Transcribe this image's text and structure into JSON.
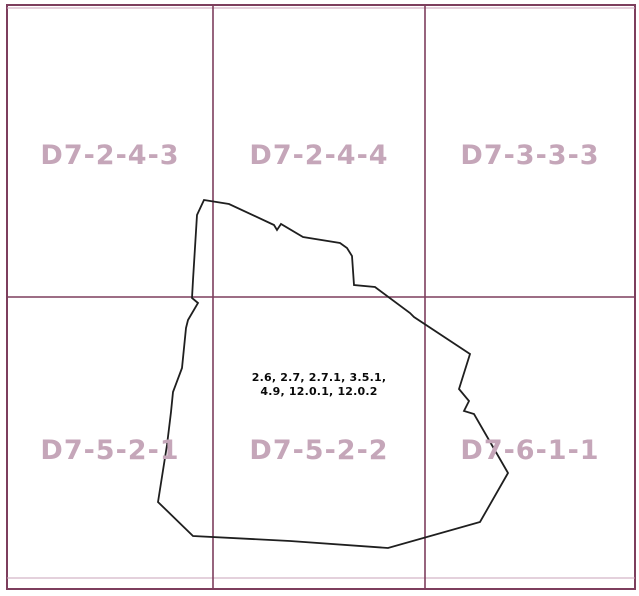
{
  "map": {
    "grid_cells": [
      {
        "label": "D7-2-4-3",
        "row": 1,
        "col": 1
      },
      {
        "label": "D7-2-4-4",
        "row": 1,
        "col": 2
      },
      {
        "label": "D7-3-3-3",
        "row": 1,
        "col": 3
      },
      {
        "label": "D7-5-2-1",
        "row": 2,
        "col": 1
      },
      {
        "label": "D7-5-2-2",
        "row": 2,
        "col": 2
      },
      {
        "label": "D7-6-1-1",
        "row": 2,
        "col": 3
      }
    ],
    "annotation": {
      "line1": "2.6, 2.7, 2.7.1, 3.5.1,",
      "line2": "4.9, 12.0.1, 12.0.2"
    },
    "boundary_polygon": {
      "points": "204,200 229,204 274,225 277,230 281,224 303,237 340,243 347,248 352,256 354,285 375,287 410,313 414,317 470,354 459,389 469,401 464,411 474,414 508,473 480,522 388,548 290,541 193,536 158,502 167,445 171,412 173,392 182,368 186,328 188,320 198,303 192,298 193,280 197,215",
      "stroke_color": "#1f1f1f"
    },
    "colors": {
      "grid_line": "#7d3e5d",
      "grid_line_faint": "#c9a3b8",
      "label_text": "#c5a6b9",
      "background": "#ffffff",
      "annotation_text": "#0a0a0a"
    }
  }
}
